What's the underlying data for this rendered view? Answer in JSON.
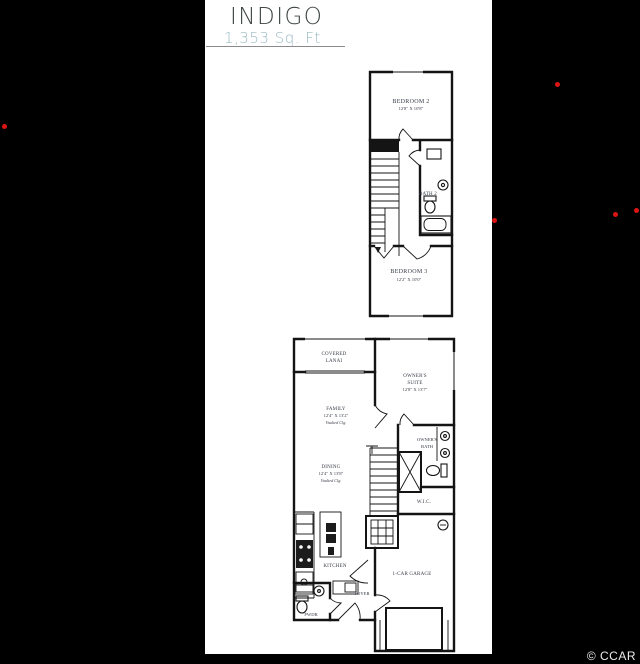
{
  "header": {
    "title": "INDIGO",
    "sqft": "1,353 Sq. Ft"
  },
  "watermark": "© CCAR",
  "colors": {
    "background": "#000000",
    "panel": "#ffffff",
    "title": "#3e4645",
    "sqft": "#9bbac3",
    "underline": "#8a8a8a",
    "wall": "#141414",
    "label": "#363b45",
    "red_dot": "#dd1512"
  },
  "floor2": {
    "bedroom2_name": "BEDROOM 2",
    "bedroom2_dims": "12'8\" X 10'8\"",
    "bath2_name": "BATH 2",
    "bedroom3_name": "BEDROOM 3",
    "bedroom3_dims": "12'2\" X 10'0\""
  },
  "floor1": {
    "lanai_line1": "COVERED",
    "lanai_line2": "LANAI",
    "suite_line1": "OWNER'S",
    "suite_line2": "SUITE",
    "suite_dims": "12'8\" X 13'7\"",
    "family_name": "FAMILY",
    "family_dims": "12'4\" X 13'2\"",
    "family_note": "Vaulted Clg.",
    "dining_name": "DINING",
    "dining_dims": "12'4\" X 13'8\"",
    "dining_note": "Vaulted Clg.",
    "bath_line1": "OWNER'S",
    "bath_line2": "BATH",
    "wic_name": "W.I.C.",
    "kitchen_name": "KITCHEN",
    "pwdr_name": "PWDR",
    "foyer_name": "FOYER",
    "garage_name": "1-CAR GARAGE"
  }
}
